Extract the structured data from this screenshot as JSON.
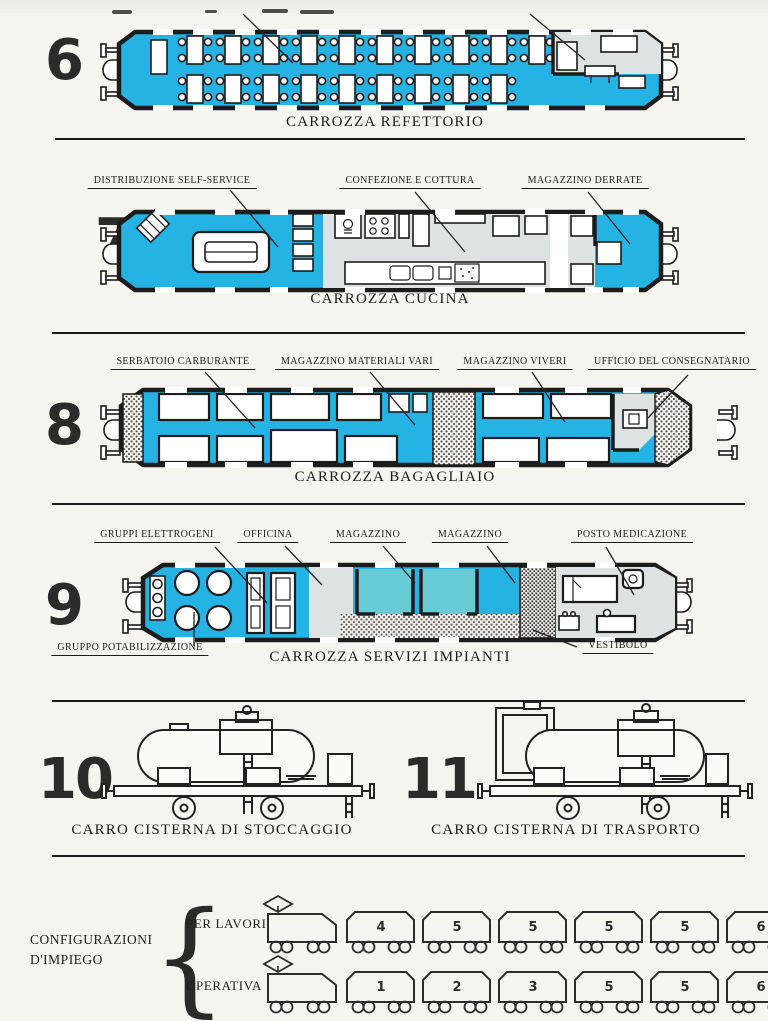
{
  "colors": {
    "cyan": "#25b3e3",
    "teal": "#68ccd6",
    "room_gray": "#dde3e2",
    "ink": "#1c1c1c",
    "paper": "#f6f4ee"
  },
  "sections": [
    {
      "number": "6",
      "caption": "CARROZZA REFETTORIO",
      "labels": []
    },
    {
      "number": "7",
      "caption": "CARROZZA CUCINA",
      "labels": [
        "DISTRIBUZIONE SELF-SERVICE",
        "CONFEZIONE E COTTURA",
        "MAGAZZINO DERRATE"
      ]
    },
    {
      "number": "8",
      "caption": "CARROZZA BAGAGLIAIO",
      "labels": [
        "SERBATOIO CARBURANTE",
        "MAGAZZINO MATERIALI VARI",
        "MAGAZZINO VIVERI",
        "UFFICIO DEL CONSEGNATARIO"
      ]
    },
    {
      "number": "9",
      "caption": "CARROZZA SERVIZI IMPIANTI",
      "labels": [
        "GRUPPI ELETTROGENI",
        "OFFICINA",
        "MAGAZZINO",
        "MAGAZZINO",
        "POSTO MEDICAZIONE"
      ],
      "labels_bottom": [
        "GRUPPO POTABILIZZAZIONE",
        "VESTIBOLO"
      ]
    },
    {
      "number": "10",
      "caption": "CARRO CISTERNA DI STOCCAGGIO"
    },
    {
      "number": "11",
      "caption": "CARRO CISTERNA DI TRASPORTO"
    }
  ],
  "configurations": {
    "title": [
      "CONFIGURAZIONI",
      "D'IMPIEGO"
    ],
    "rows": [
      {
        "label": "PER LAVORI",
        "cars": [
          "4",
          "5",
          "5",
          "5",
          "5",
          "6"
        ]
      },
      {
        "label": "OPERATIVA",
        "cars": [
          "1",
          "2",
          "3",
          "5",
          "5",
          "6"
        ]
      }
    ]
  }
}
